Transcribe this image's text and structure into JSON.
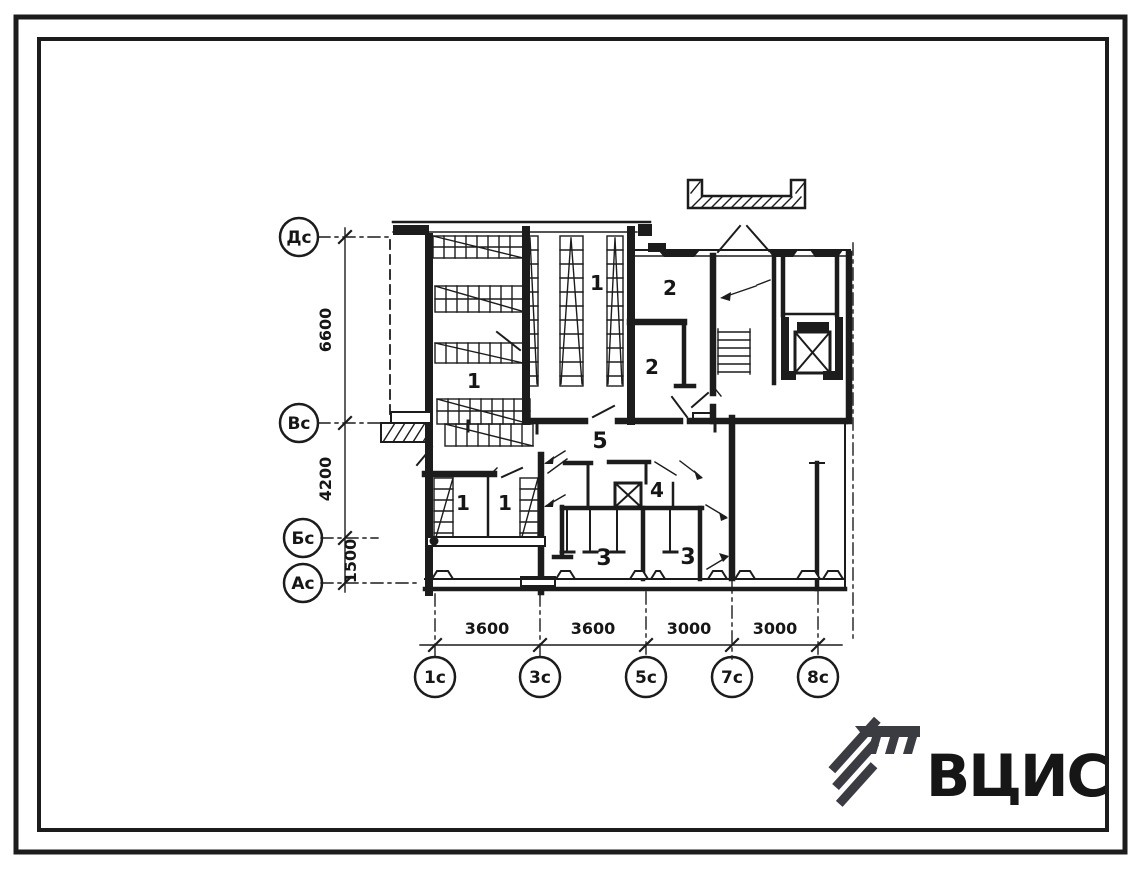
{
  "axes": {
    "left_labels": [
      "Дс",
      "Вс",
      "Бс",
      "Ас"
    ],
    "bottom_labels": [
      "1с",
      "3с",
      "5с",
      "7с",
      "8с"
    ],
    "left_dims": [
      "6600",
      "4200",
      "1500"
    ],
    "bottom_dims": [
      "3600",
      "3600",
      "3000",
      "3000"
    ]
  },
  "rooms": {
    "labels": [
      "1",
      "1",
      "2",
      "2",
      "5",
      "1",
      "1",
      "4",
      "3",
      "3"
    ]
  },
  "logo": {
    "text": "ВЦИС",
    "color": "#3b3b42"
  },
  "colors": {
    "ink": "#1c1c1c",
    "paper": "#ffffff"
  }
}
